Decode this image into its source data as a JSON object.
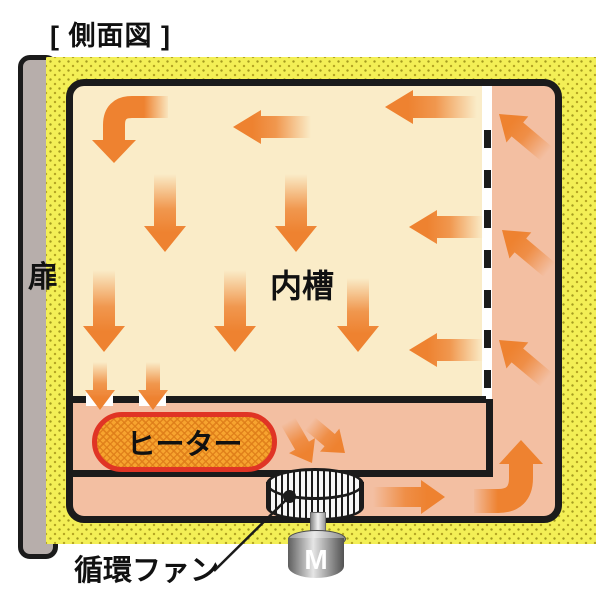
{
  "page": {
    "title": "[ 側面図 ]"
  },
  "diagram": {
    "labels": {
      "door": "扉",
      "inner_chamber": "内槽",
      "heater": "ヒーター",
      "circulation_fan": "循環ファン",
      "motor": "M"
    },
    "colors": {
      "insulation_yellow": "#f3ef56",
      "insulation_dot": "#a39a1f",
      "chamber_cream": "#faecc8",
      "duct_salmon": "#f3bfa2",
      "arrow_orange": "#ee8230",
      "heater_fill": "#f7a42f",
      "heater_border": "#e03425",
      "wall_black": "#1b1b1b",
      "door_gray": "#b7aeab"
    },
    "airflow_arrows": [
      {
        "name": "chamber-left-arrow-1",
        "x": 233,
        "y": 127,
        "rot": 90,
        "len": 78,
        "sw": 11,
        "hw": 17,
        "hl": 28
      },
      {
        "name": "chamber-left-arrow-2",
        "x": 385,
        "y": 107,
        "rot": 90,
        "len": 92,
        "sw": 11,
        "hw": 17,
        "hl": 28
      },
      {
        "name": "chamber-down-arrow-r1c1",
        "x": 165,
        "y": 252,
        "rot": 0,
        "len": 78,
        "sw": 11,
        "hw": 21,
        "hl": 26
      },
      {
        "name": "chamber-down-arrow-r1c2",
        "x": 296,
        "y": 252,
        "rot": 0,
        "len": 78,
        "sw": 11,
        "hw": 21,
        "hl": 26
      },
      {
        "name": "chamber-left-arrow-3",
        "x": 409,
        "y": 227,
        "rot": 90,
        "len": 74,
        "sw": 11,
        "hw": 17,
        "hl": 28
      },
      {
        "name": "chamber-down-arrow-r2c1",
        "x": 104,
        "y": 352,
        "rot": 0,
        "len": 82,
        "sw": 11,
        "hw": 21,
        "hl": 26
      },
      {
        "name": "chamber-down-arrow-r2c2",
        "x": 235,
        "y": 352,
        "rot": 0,
        "len": 82,
        "sw": 11,
        "hw": 21,
        "hl": 26
      },
      {
        "name": "chamber-down-arrow-r2c3",
        "x": 358,
        "y": 352,
        "rot": 0,
        "len": 74,
        "sw": 11,
        "hw": 21,
        "hl": 26
      },
      {
        "name": "chamber-left-arrow-4",
        "x": 409,
        "y": 350,
        "rot": 90,
        "len": 74,
        "sw": 11,
        "hw": 17,
        "hl": 28
      },
      {
        "name": "floor-pass-arrow-1",
        "x": 100,
        "y": 410,
        "rot": 0,
        "len": 48,
        "sw": 7,
        "hw": 15,
        "hl": 20
      },
      {
        "name": "floor-pass-arrow-2",
        "x": 153,
        "y": 410,
        "rot": 0,
        "len": 48,
        "sw": 7,
        "hw": 15,
        "hl": 20
      },
      {
        "name": "right-duct-up-arrow-1",
        "x": 499,
        "y": 114,
        "rot": 130,
        "len": 62,
        "sw": 9,
        "hw": 17,
        "hl": 24
      },
      {
        "name": "right-duct-up-arrow-2",
        "x": 502,
        "y": 230,
        "rot": 130,
        "len": 62,
        "sw": 9,
        "hw": 17,
        "hl": 24
      },
      {
        "name": "right-duct-up-arrow-3",
        "x": 499,
        "y": 340,
        "rot": 130,
        "len": 62,
        "sw": 9,
        "hw": 17,
        "hl": 24
      },
      {
        "name": "to-fan-arrow-1",
        "x": 312,
        "y": 463,
        "rot": -30,
        "len": 48,
        "sw": 8,
        "hw": 15,
        "hl": 20
      },
      {
        "name": "to-fan-arrow-2",
        "x": 345,
        "y": 453,
        "rot": -50,
        "len": 46,
        "sw": 8,
        "hw": 15,
        "hl": 20
      },
      {
        "name": "bottom-duct-right-arrow",
        "x": 445,
        "y": 497,
        "rot": -90,
        "len": 72,
        "sw": 10,
        "hw": 17,
        "hl": 24
      }
    ]
  }
}
